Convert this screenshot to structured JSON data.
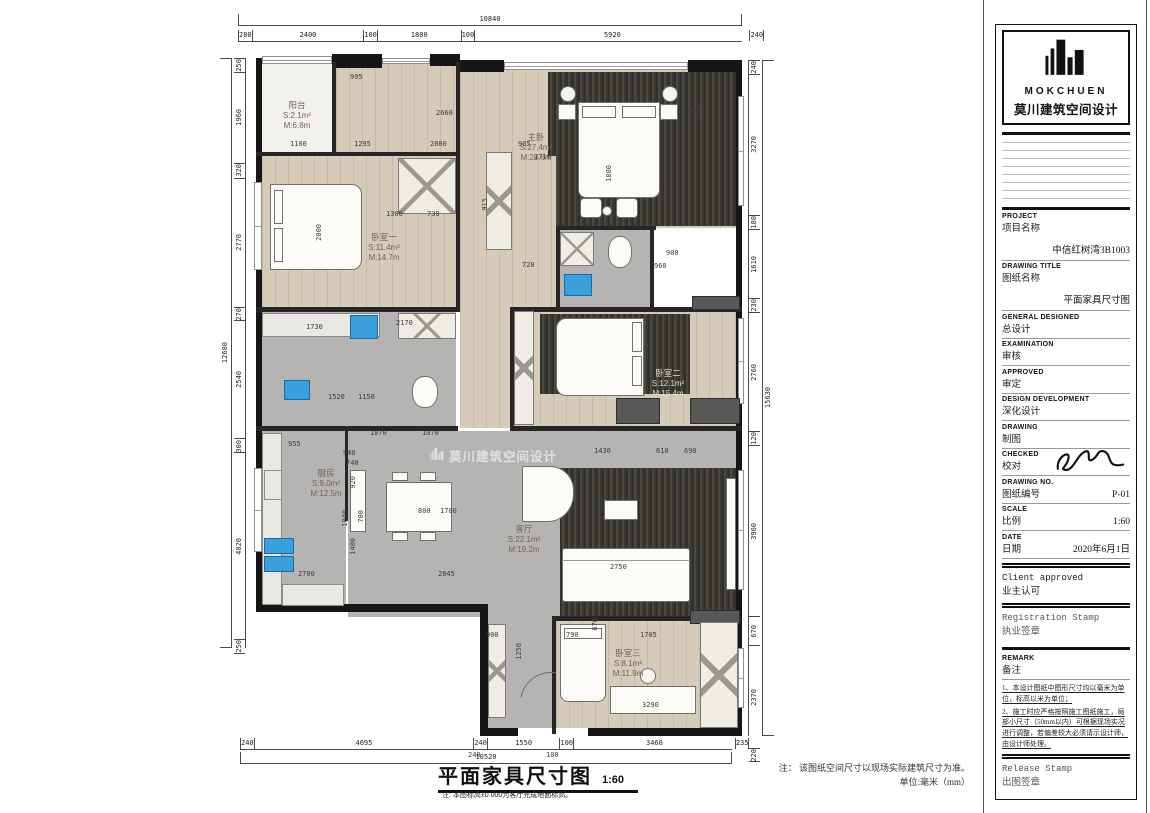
{
  "plan": {
    "watermark": "莫川建筑空间设计",
    "rooms": [
      {
        "name": "阳台",
        "s": "S:2.1m²",
        "m": "M:6.8m",
        "x": 297,
        "y": 116,
        "light": false
      },
      {
        "name": "主卧",
        "s": "S:27.4m²",
        "m": "M:28.6m",
        "x": 536,
        "y": 148,
        "light": false
      },
      {
        "name": "卧室一",
        "s": "S:11.4m²",
        "m": "M:14.7m",
        "x": 384,
        "y": 248,
        "light": false
      },
      {
        "name": "卧室二",
        "s": "S:12.1m²",
        "m": "M:15.4m",
        "x": 668,
        "y": 384,
        "light": true
      },
      {
        "name": "厨房",
        "s": "S:9.0m²",
        "m": "M:12.5m",
        "x": 326,
        "y": 484,
        "light": false
      },
      {
        "name": "客厅",
        "s": "S:22.1m²",
        "m": "M:19.2m",
        "x": 524,
        "y": 540,
        "light": false
      },
      {
        "name": "卧室三",
        "s": "S:8.1m²",
        "m": "M:11.9m",
        "x": 628,
        "y": 664,
        "light": false
      }
    ],
    "dims": {
      "top": {
        "total": "10840",
        "segments": [
          "280",
          "2400",
          "100",
          "1800",
          "100",
          "5920",
          "240"
        ]
      },
      "bottom": {
        "total": "10520",
        "segments": [
          "240",
          "4695",
          "240",
          "1550",
          "100",
          "3460",
          "235"
        ]
      },
      "left": {
        "total": "12680",
        "segments": [
          "250",
          "1960",
          "320",
          "2770",
          "270",
          "2540",
          "300",
          "4020",
          "250"
        ]
      },
      "right": {
        "total": "15630",
        "segments": [
          "240",
          "3270",
          "180",
          "1610",
          "230",
          "2760",
          "120",
          "3960",
          "670",
          "2370",
          "220"
        ]
      }
    },
    "inner_dims": [
      {
        "t": "995",
        "x": 350,
        "y": 74
      },
      {
        "t": "2660",
        "x": 436,
        "y": 110
      },
      {
        "t": "1100",
        "x": 290,
        "y": 141
      },
      {
        "t": "1295",
        "x": 354,
        "y": 141
      },
      {
        "t": "2080",
        "x": 430,
        "y": 141
      },
      {
        "t": "905",
        "x": 518,
        "y": 141
      },
      {
        "t": "1710",
        "x": 534,
        "y": 154
      },
      {
        "t": "480",
        "x": 688,
        "y": 108
      },
      {
        "t": "1800",
        "x": 606,
        "y": 165,
        "r": 1
      },
      {
        "t": "2000",
        "x": 316,
        "y": 224,
        "r": 1
      },
      {
        "t": "1300",
        "x": 386,
        "y": 211
      },
      {
        "t": "730",
        "x": 427,
        "y": 211
      },
      {
        "t": "915",
        "x": 482,
        "y": 198,
        "r": 1
      },
      {
        "t": "720",
        "x": 522,
        "y": 262
      },
      {
        "t": "960",
        "x": 654,
        "y": 263
      },
      {
        "t": "900",
        "x": 666,
        "y": 250
      },
      {
        "t": "2170",
        "x": 396,
        "y": 320
      },
      {
        "t": "1730",
        "x": 306,
        "y": 324
      },
      {
        "t": "1520",
        "x": 328,
        "y": 394
      },
      {
        "t": "1150",
        "x": 358,
        "y": 394
      },
      {
        "t": "955",
        "x": 288,
        "y": 441
      },
      {
        "t": "1870",
        "x": 370,
        "y": 430
      },
      {
        "t": "1070",
        "x": 422,
        "y": 430
      },
      {
        "t": "940",
        "x": 343,
        "y": 450
      },
      {
        "t": "740",
        "x": 346,
        "y": 460
      },
      {
        "t": "1430",
        "x": 594,
        "y": 448
      },
      {
        "t": "610",
        "x": 656,
        "y": 448
      },
      {
        "t": "690",
        "x": 684,
        "y": 448
      },
      {
        "t": "920",
        "x": 350,
        "y": 476,
        "r": 1
      },
      {
        "t": "1040",
        "x": 342,
        "y": 510,
        "r": 1
      },
      {
        "t": "700",
        "x": 358,
        "y": 510,
        "r": 1
      },
      {
        "t": "800",
        "x": 418,
        "y": 508
      },
      {
        "t": "1700",
        "x": 440,
        "y": 508
      },
      {
        "t": "1400",
        "x": 350,
        "y": 538,
        "r": 1
      },
      {
        "t": "2700",
        "x": 298,
        "y": 571
      },
      {
        "t": "2845",
        "x": 438,
        "y": 571
      },
      {
        "t": "2750",
        "x": 610,
        "y": 564
      },
      {
        "t": "790",
        "x": 566,
        "y": 632
      },
      {
        "t": "670",
        "x": 592,
        "y": 618,
        "r": 1
      },
      {
        "t": "1705",
        "x": 640,
        "y": 632
      },
      {
        "t": "3290",
        "x": 642,
        "y": 702
      },
      {
        "t": "1250",
        "x": 516,
        "y": 643,
        "r": 1
      },
      {
        "t": "900",
        "x": 486,
        "y": 632
      },
      {
        "t": "240",
        "x": 468,
        "y": 752
      },
      {
        "t": "100",
        "x": 546,
        "y": 752
      }
    ],
    "bottom_title": {
      "text": "平面家具尺寸图",
      "scale": "1:60",
      "note": "注: 本图标高±0.000为客厅完成地面标高。"
    },
    "note_line1": "注： 该图纸空间尺寸以现场实际建筑尺寸为准。",
    "note_line2": "单位:毫米（mm）"
  },
  "titleblock": {
    "brand": "MOKCHUEN",
    "brand_cn": "莫川建筑空间设计",
    "fields": [
      {
        "en": "PROJECT",
        "cn": "项目名称",
        "value": "中信红树湾3B1003",
        "big": true
      },
      {
        "en": "DRAWING TITLE",
        "cn": "图纸名称",
        "value": "平面家具尺寸图",
        "big": true
      },
      {
        "en": "GENERAL DESIGNED",
        "cn": "总设计",
        "value": ""
      },
      {
        "en": "EXAMINATION",
        "cn": "审核",
        "value": ""
      },
      {
        "en": "APPROVED",
        "cn": "审定",
        "value": ""
      },
      {
        "en": "DESIGN DEVELOPMENT",
        "cn": "深化设计",
        "value": ""
      },
      {
        "en": "DRAWING",
        "cn": "制图",
        "value": ""
      },
      {
        "en": "CHECKED",
        "cn": "校对",
        "value": "",
        "signature": true
      },
      {
        "en": "DRAWING NO.",
        "cn": "图纸编号",
        "value": "P-01"
      },
      {
        "en": "SCALE",
        "cn": "比例",
        "value": "1:60"
      },
      {
        "en": "DATE",
        "cn": "日期",
        "value": "2020年6月1日"
      }
    ],
    "client_stamp": {
      "en": "Client approved",
      "cn": "业主认可"
    },
    "registration_stamp": {
      "en": "Registration Stamp",
      "cn": "执业签章"
    },
    "remark": {
      "en": "REMARK",
      "cn": "备注",
      "items": [
        "1、本设计图纸中图形尺寸均以毫米为单位，标高以米为单位；",
        "2、施工时应严格按照施工图纸施工，局部小尺寸（50mm以内）可根据现场实况进行调整，若偏差较大必须请示设计师，由设计师处理。"
      ]
    },
    "release_stamp": {
      "en": "Release Stamp",
      "cn": "出图签章"
    }
  }
}
